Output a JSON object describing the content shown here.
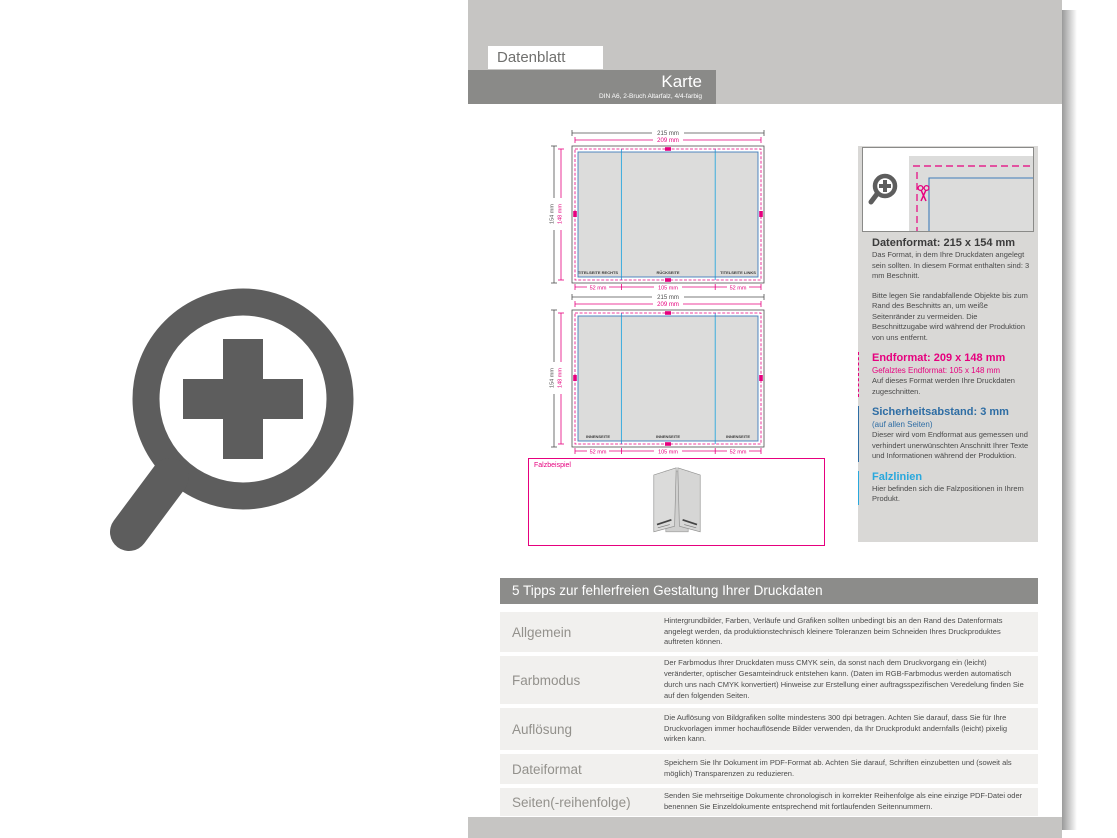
{
  "page": {
    "tab": "Datenblatt",
    "title": "Karte",
    "subtitle": "DIN A6, 2-Bruch Altarfalz, 4/4-farbig"
  },
  "colors": {
    "accent_magenta": "#e6007e",
    "accent_blue": "#2e6da4",
    "accent_cyan": "#29a8dd",
    "band_gray": "#c6c5c3",
    "title_band_gray": "#8a8a88",
    "row_gray": "#f1f0ee",
    "icon_gray": "#5d5d5d"
  },
  "icons": {
    "zoom_plus": "magnifier-with-plus",
    "scissors": "scissors",
    "magnifier_small": "magnifier-with-plus"
  },
  "diagrams": {
    "outside": {
      "width_outer": "215 mm",
      "width_inner": "209 mm",
      "height_outer": "154 mm",
      "height_inner": "148 mm",
      "panel_w1": "52 mm",
      "panel_w2": "105 mm",
      "panel_w3": "52 mm",
      "panels": [
        "TITELSEITE RECHTS",
        "RÜCKSEITE",
        "TITELSEITE LINKS"
      ]
    },
    "inside": {
      "width_outer": "215 mm",
      "width_inner": "209 mm",
      "height_outer": "154 mm",
      "height_inner": "148 mm",
      "panel_w1": "52 mm",
      "panel_w2": "105 mm",
      "panel_w3": "52 mm",
      "panels": [
        "INNENSEITE",
        "INNENSEITE",
        "INNENSEITE"
      ]
    },
    "fold_example_label": "Falzbeispiel"
  },
  "info_panel": {
    "datenformat": {
      "heading": "Datenformat: 215 x 154 mm",
      "body": "Das Format, in dem Ihre Druckdaten angelegt sein sollten. In diesem Format enthalten sind: 3 mm Beschnitt."
    },
    "bleed_note": "Bitte legen Sie randabfallende Objekte bis zum Rand des Beschnitts an, um weiße Seitenränder zu vermeiden. Die Beschnittzugabe wird während der Produktion von uns entfernt.",
    "endformat": {
      "heading": "Endformat: 209 x 148 mm",
      "subheading": "Gefalztes Endformat: 105 x 148 mm",
      "body": "Auf dieses Format werden Ihre Druckdaten zugeschnitten."
    },
    "sicherheitsabstand": {
      "heading": "Sicherheitsabstand: 3 mm",
      "subheading": "(auf allen Seiten)",
      "body": "Dieser wird vom Endformat aus gemessen und verhindert unerwünschten Anschnitt Ihrer Texte und Informationen während der Produktion."
    },
    "falzlinien": {
      "heading": "Falzlinien",
      "body": "Hier befinden sich die Falzpositionen in Ihrem Produkt."
    }
  },
  "tips": {
    "header": "5 Tipps zur fehlerfreien Gestaltung Ihrer Druckdaten",
    "rows": [
      {
        "label": "Allgemein",
        "text": "Hintergrundbilder, Farben, Verläufe und Grafiken sollten unbedingt bis an den Rand des Datenformats angelegt werden, da produktionstechnisch kleinere Toleranzen beim Schneiden Ihres Druckproduktes auftreten können."
      },
      {
        "label": "Farbmodus",
        "text": "Der Farbmodus Ihrer Druckdaten muss CMYK sein, da sonst nach dem Druckvorgang ein (leicht) veränderter, optischer Gesamteindruck entstehen kann. (Daten im RGB-Farbmodus werden automatisch durch uns nach CMYK konvertiert) Hinweise zur Erstellung einer auftragsspezifischen Veredelung finden Sie auf den folgenden Seiten."
      },
      {
        "label": "Auflösung",
        "text": "Die Auflösung von Bildgrafiken sollte mindestens 300 dpi betragen. Achten Sie darauf, dass Sie für Ihre Druckvorlagen immer hochauflösende Bilder verwenden, da Ihr Druckprodukt andernfalls (leicht) pixelig wirken kann."
      },
      {
        "label": "Dateiformat",
        "text": "Speichern Sie Ihr Dokument im PDF-Format ab. Achten Sie darauf, Schriften einzubetten und (soweit als möglich) Transparenzen zu reduzieren."
      },
      {
        "label": "Seiten(-reihenfolge)",
        "text": "Senden Sie mehrseitige Dokumente chronologisch in korrekter Reihenfolge als eine einzige PDF-Datei oder benennen Sie Einzeldokumente entsprechend mit fortlaufenden Seitennummern."
      }
    ]
  }
}
